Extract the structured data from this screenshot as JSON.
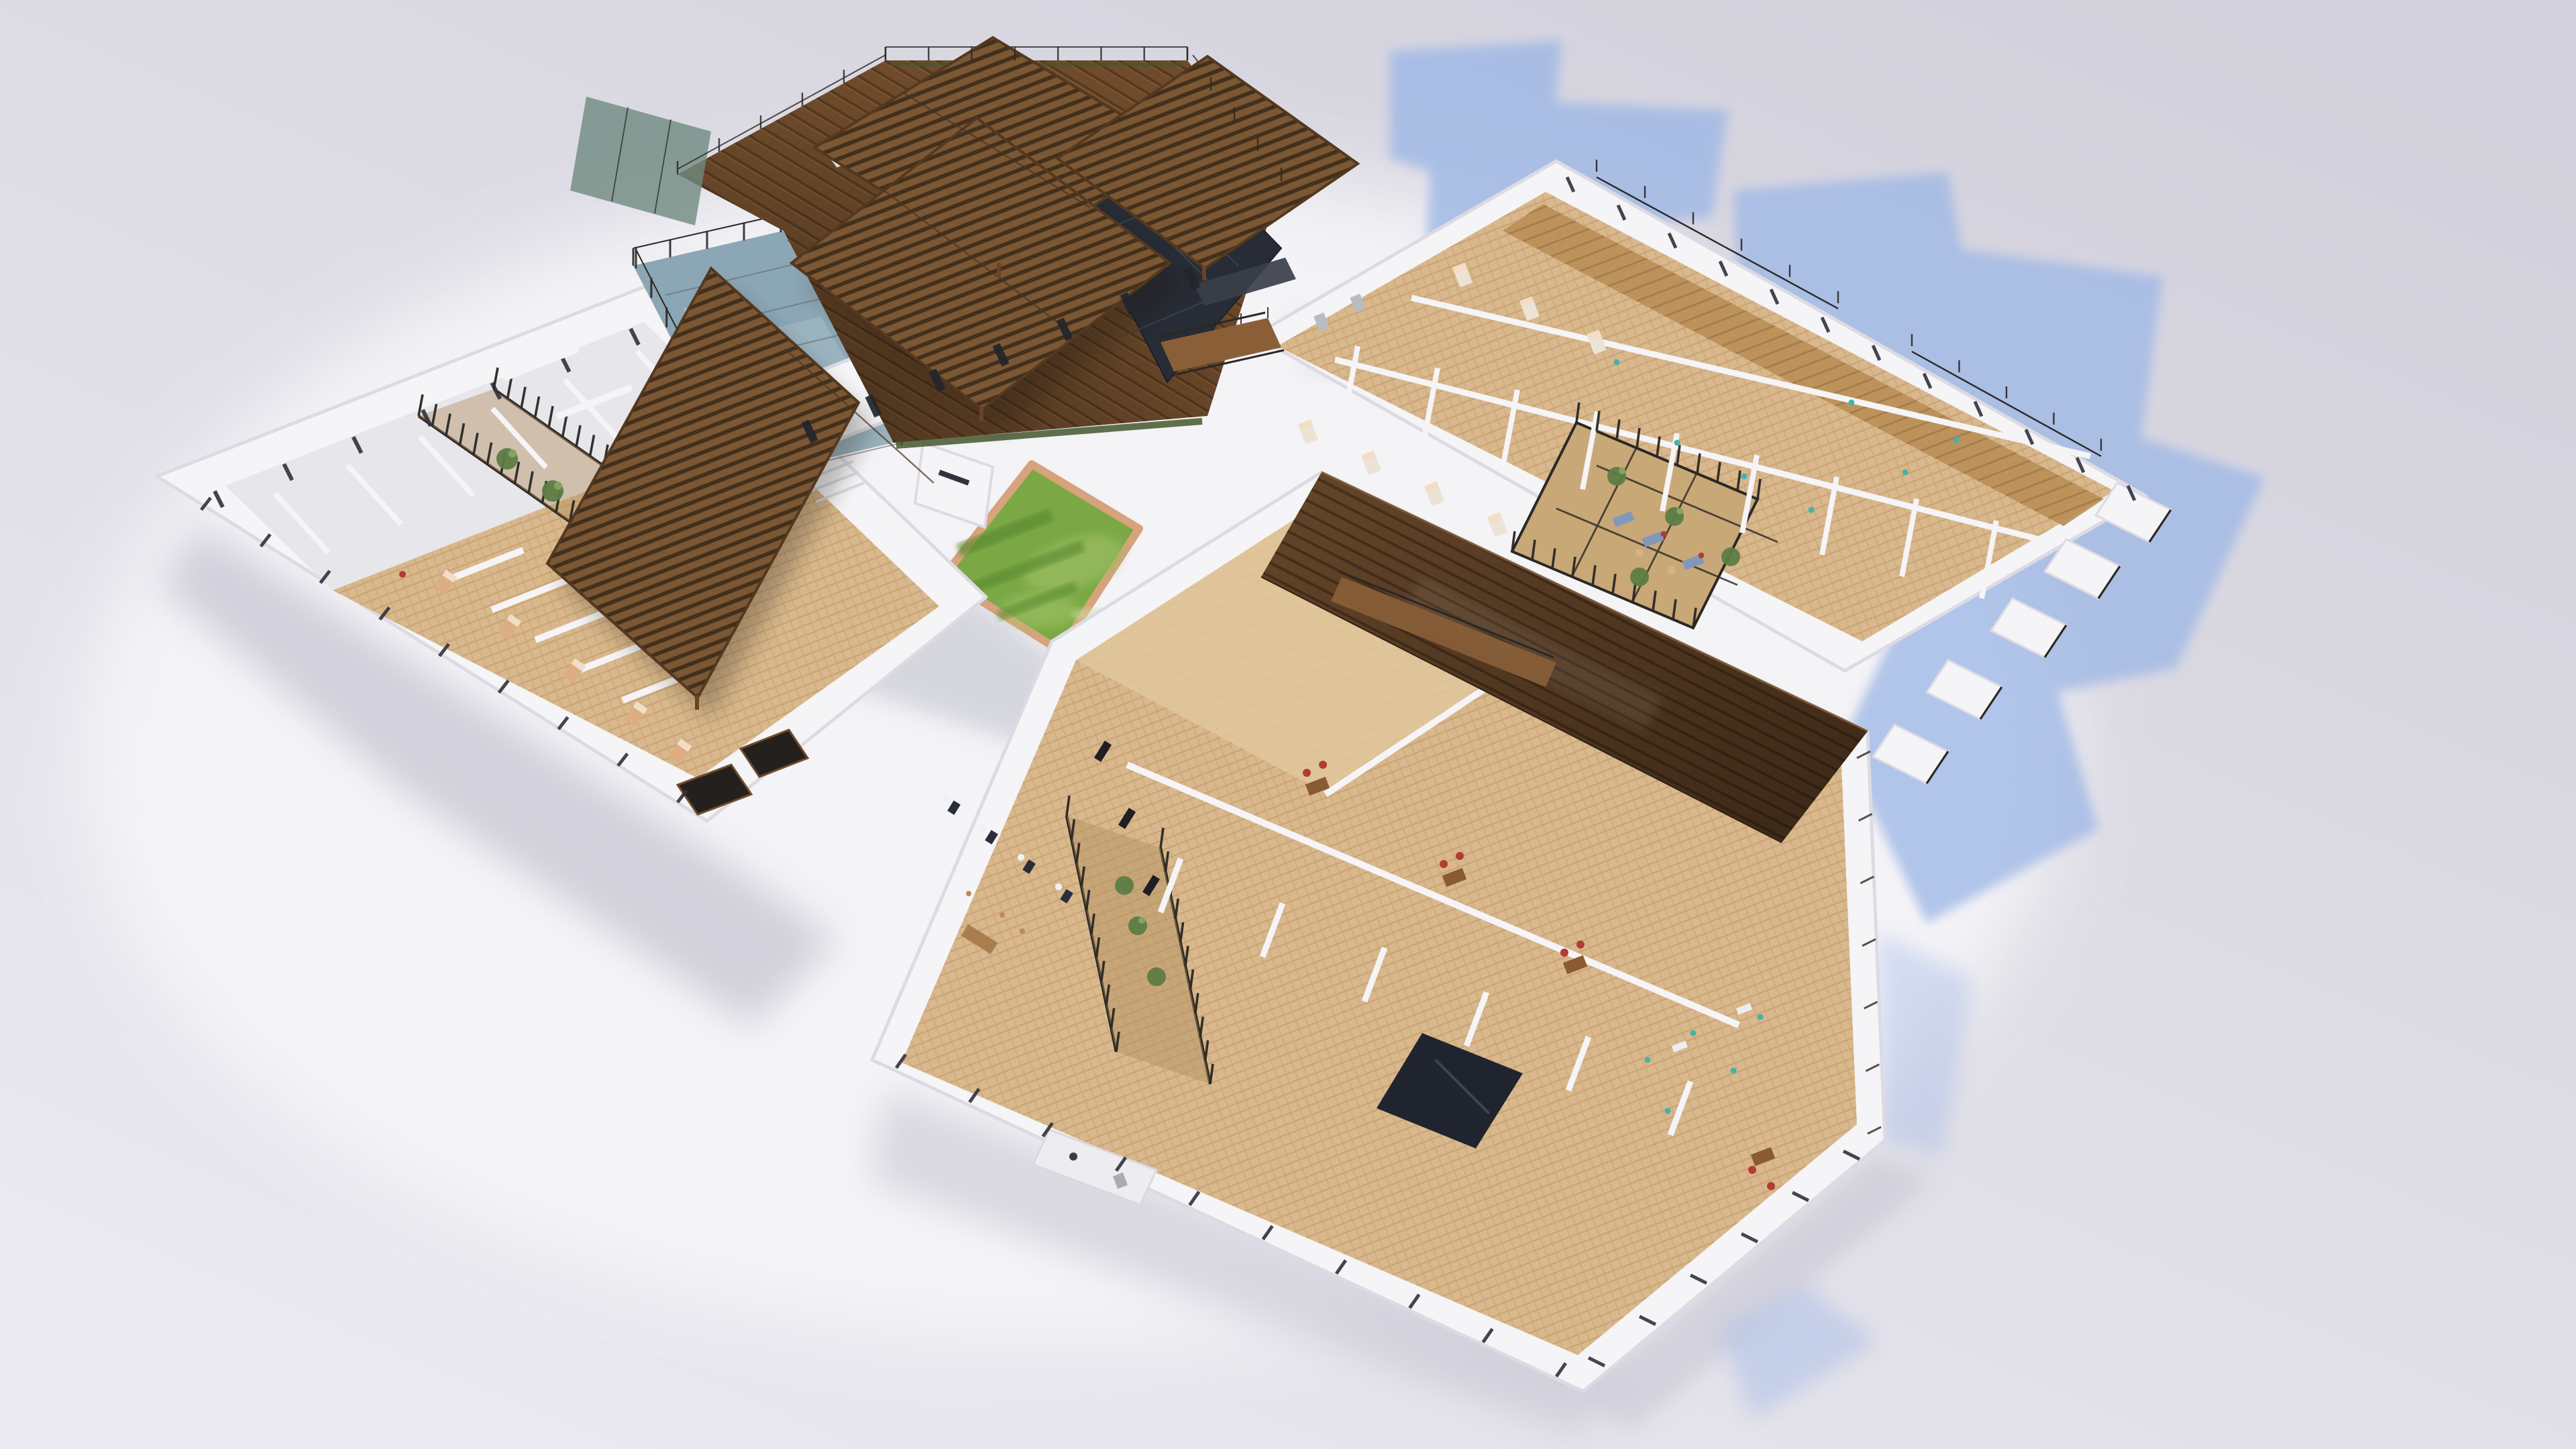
{
  "meta": {
    "title": "Aerial axonometric 3D rendering of a U-shaped residential care complex",
    "view": "bird's-eye cutaway floor plan, daylight, no visible text",
    "visible_text": "none"
  },
  "palette": {
    "background": "#d2d1db",
    "background_light": "#eceaf1",
    "glow": "#f7f6f9",
    "shadow_blue": "#9fb8e6",
    "shadow_gray": "#c6c5d2",
    "wall": "#f5f4f6",
    "wall_edge": "#dcdbe3",
    "floor_gray": "#e7e6eb",
    "tile": "#d8b88c",
    "tile_line": "#c8a274",
    "wood_room": "#bb9057",
    "wood_room_line": "#a0784a",
    "deck": "#6e4b2b",
    "deck_line": "#57391f",
    "pergola": "#7b5734",
    "pergola_gap": "#43301c",
    "roof_wood": "#65462a",
    "roof_wood_line": "#49311b",
    "roof_dark": "#272c36",
    "water": "#8ba6b4",
    "water_deep": "#7591a1",
    "glass": "#a9bfc9",
    "grass": "#7ba845",
    "grass_light": "#98bb5e",
    "grass_dark": "#5a8a33",
    "grass_border": "#d6a37d",
    "frame": "#2b2824",
    "window": "#33323c",
    "plant": "#5d7c45",
    "plant_light": "#83a45f",
    "bed_tan": "#dcae82",
    "bed_white": "#ebe3d3",
    "pillow": "#f2ddc6",
    "sofa": "#8298bb",
    "chair_red": "#b23c35",
    "teal": "#43b1ac",
    "desk": "#8a5a33",
    "counter": "#ededf1",
    "steel": "#a8adb4",
    "navy": "#2a2d3a",
    "dark_floor": "#20242e",
    "bridge_wood": "#8a5f38"
  },
  "scene": {
    "buildings": [
      {
        "id": "west-wing",
        "label": "West residential wing",
        "features": [
          "cutaway bedrooms with beds",
          "central atrium with black slatted screens and plants",
          "window slots",
          "dark balconies at south corner"
        ]
      },
      {
        "id": "central-pavilion",
        "label": "Central pavilion",
        "features": [
          "four slatted timber pergola roofs",
          "rooftop timber deck with glass balustrade",
          "dark tiled roof section",
          "white facade with tall windows",
          "swimming pool under glass canopy",
          "timber footbridge"
        ]
      },
      {
        "id": "northeast-wing",
        "label": "North-east residential wing",
        "features": [
          "rows of bedrooms with en-suite bathrooms",
          "lounge atrium with blue sofas, red cushions and plants",
          "stepped balconies with dark railings",
          "timber walkway"
        ]
      },
      {
        "id": "southeast-wing",
        "label": "South-east day-care wing",
        "features": [
          "open hall with red-chair workstations",
          "hair-salon wash stations",
          "slatted atrium with plants",
          "kitchen",
          "dark media room",
          "long timber roof strip over corridor"
        ]
      }
    ],
    "courtyard": {
      "label": "Central courtyard",
      "features": [
        "square lawn planter with timber edge",
        "timber terrace with glass railing"
      ]
    },
    "environment": {
      "lighting": "daylight from upper left",
      "shadows": "blue-tinted cast shadows falling to the right",
      "ground": "pale lavender-grey backdrop"
    }
  }
}
